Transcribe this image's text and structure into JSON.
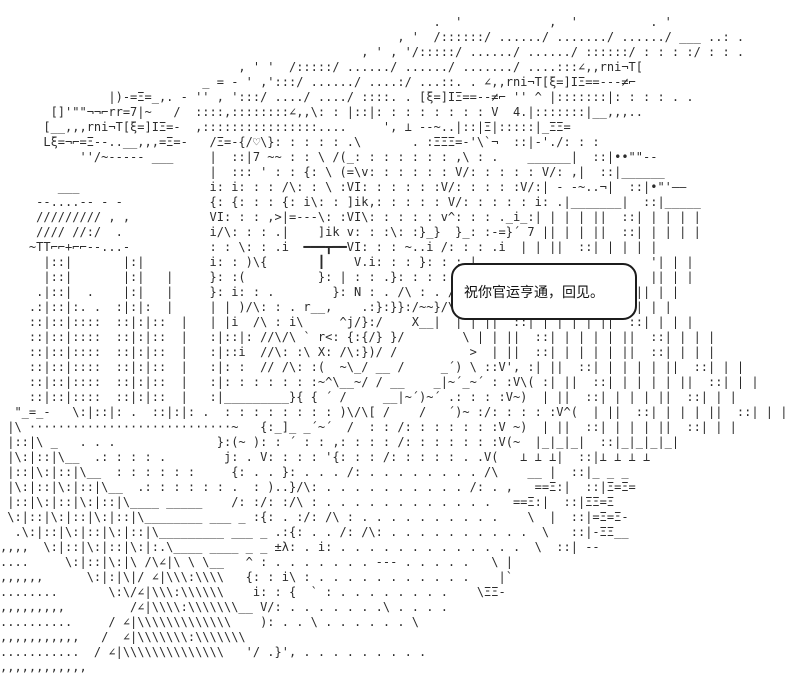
{
  "scene": {
    "colors": {
      "background": "#ffffff",
      "ink": "#2b2b2b",
      "bubble_border": "#1c1c1c",
      "bubble_background": "#ffffff"
    },
    "dialogue": {
      "text": "祝你官运亨通，回见。"
    },
    "ascii_art": {
      "lines": [
        "",
        "                                                            .  '            ,  '          . '",
        "                                                       , '  /::::::/ ....../ ......./ ....../ ___ ..: .",
        "                                                  , ' , '/:::::/ ....../ ....../ ::::::/ : : : :/ : : .",
        "                                 , ' '  /:::::/ ....../ ....../ ......./ ....:::∠,,rni¬T[",
        "                            _ = - ' ,':::/ ....../ ....:/ ...::. . ∠,,rni¬T[ξ=]IΞ==---≠⌐",
        "               |)-=Ξ=_,. - '' , ':::/ ..../ ..../ ::::. . [ξ=]IΞ==--≠⌐ '' ^ |:::::::|: : : : . .",
        "       []'\"\"¬¬⌐rr=7|~   /  ::::,::::::::∠,,\\: : |::|: : : : : : : : V  4.|:::::::|__,,,..",
        "      [__,,,rni¬T[ξ=]IΞ=-  ,::::::::::::::::....     ', ⊥ --~..|::|Ξ|:::::|_ΞΞ=",
        "      Lξ=¬⌐=Ξ--..__,,,=Ξ=-   /Ξ=-{/♡\\}: : : : : .\\       . :ΞΞΞ=-'\\`¬  ::|-'./: : :",
        "           ''/~----- ___     |  ::|7 ~~ : : \\ /(_: : : : : : : ,\\ : .    ______|  ::|••\"\"--",
        "                             |  ::: ' : : {: \\ (=\\v: : : : : : V/: : : : : V/: ,|  ::|______",
        "        ___                  i: i: : : /\\: : \\ :VI: : : : : :V/: : : : :V/:| - -~..¬|  ::|•\"'——",
        "     --....-- - -            {: {: : : {: i\\: : ]ik,: : : : : V/: : : : : i: .|_______|  ::|_____",
        "     ///////// , ,           VI: : : ,>|=---\\: :VI\\: : : : : v^: : : ._i_:| | | | ||  ::| | | | |",
        "     //// //:/  .            i/\\: : : .|    ]ik v: : :\\: :}_}  }_: :-=}´ 7 || | | ||  ::| | | | |",
        "    ~TT⌐⌐+⌐⌐--...-           : : \\: : .i  ━━━┳━━VI: : : ~..i /: : : .i  | | ||  ::| | | | |",
        "      |::|       |:|         i: : )\\{       ┃    V.i: : : }: : :.|                        '| | |",
        "      |::|       |:|   |     }: :(          }: | : : .}: : : : f                          || | |",
        "     .|::|  .    |:|   |     }: i: : .        }: N : . /\\ : . /:/Y                      || | |",
        "    .:|::|:. .  :|:|:  |     | | )/\\: : . r__,    .:}:}}:/~~}/\\:/|/                    )| | |",
        "    ::|::|::::  ::|:|::  |   | |i  /\\ : i\\     ^j/}:/    X__|  | | ||  ::| | | | | ||  ::| | | |",
        "    ::|::|::::  ::|:|::  |   :|::|: //\\/\\ ` r<: {:{/} }/        \\ | | ||  ::| | | | | ||  ::| | | |",
        "    ::|::|::::  ::|:|::  |   :|::i  //\\: :\\ X: /\\:})/ /          >  | ||  ::| | | | | ||  ::| | | |",
        "    ::|::|::::  ::|:|::  |   :|: :  // /\\: :(  ~\\_/ __ /     _´) \\ ::V', :| ||  ::| | | | | ||  ::| | |",
        "    ::|::|::::  ::|:|::  |   :|: : : : : : :~^\\__~/ / __    _|~´_~´ : :V\\( :| ||  ::| | | | | ||  ::| | |",
        "    ::|::|::::  ::|:|::  |   :|_________}{ { ´ /     __|~´)~´ .: : : :V~)  | ||  ::| | | | ||  ::| | |",
        "  \"_=_-   \\:|::|: .  ::|:|: .  : : : : : : : : )\\/\\[ /    /   ´)~ :/: : : : :V^(  | ||  ::| | | | ||  ::| | |",
        " |\\ ····························~   {:_]_ _´~´  /  : : /: : : : : : :V ~)  | ||  ::| | | | ||  ::| | |",
        " |::|\\ _   . . .              }:(~ ): : ´ : : ,: : : : /: : : : : : :V(~  |_|_|_|  ::|_|_|_|_|",
        " |\\:|::|\\__  .: : : : .        j: . V: : : : '{: : : /: : : : : . .V(   ⊥ ⊥ ⊥|  ::|⊥ ⊥ ⊥ ⊥",
        " |::|\\:|::|\\__  : : : : : :     {: . . }: . . . /: . . . . . . . . /\\    __ |  ::|_ _ _",
        " |\\:|::|\\:|::|\\__  .: : : : : : .  : )..}/\\: . . . . . . . . . . /: . ,   ==Ξ:|  ::|Ξ=Ξ=",
        " |::|\\:|::|\\:|::|\\____ _____    /: :/: :/\\ : . . . . . . . . . . . .   ==Ξ:|  ::|ΞΞ=Ξ",
        " \\:|::|\\:|::|\\:|::|\\________ ___ _ :{: . :/: /\\ : . . . . . . . . . .    \\  |  ::|=Ξ=Ξ-",
        "  .\\:|::|\\:|::|\\:|::|\\_________ ___ _ .:{: . . /: /\\: . . . . . . . . . .  \\   ::|-ΞΞ__",
        ",,,,  \\:|::|\\:|::|\\:|:.\\____ ____ _ _ ±λ: . i: . . . . . . . . . . . . .  \\  ::| --",
        "....     \\:|::|\\:|\\ /\\∠|\\ \\ \\__   ^ : . . . . . . . --- . . . . .   \\ |",
        ",,,,,,      \\:|:|\\|/ ∠|\\\\\\:\\\\\\\\   {: : i\\ : . . . . . . . . . . .    |`",
        "........       \\:\\/∠|\\\\\\:\\\\\\\\\\\\    i: : {  ` : . . . . . . . .    \\ΞΞ-",
        ",,,,,,,,,         /∠|\\\\\\\\:\\\\\\\\\\\\\\__ V/: . . . . . . .\\ . . . .",
        "..........     / ∠|\\\\\\\\\\\\\\\\\\\\\\\\\\    ): . . \\ . . . . . . \\",
        ",,,,,,,,,,,   /  ∠|\\\\\\\\\\\\\\:\\\\\\\\\\\\\\",
        "...........  / ∠|\\\\\\\\\\\\\\\\\\\\\\\\\\\\   '/ .}', . . . . . . . . .",
        ",,,,,,,,,,,,",
        ""
      ]
    }
  }
}
